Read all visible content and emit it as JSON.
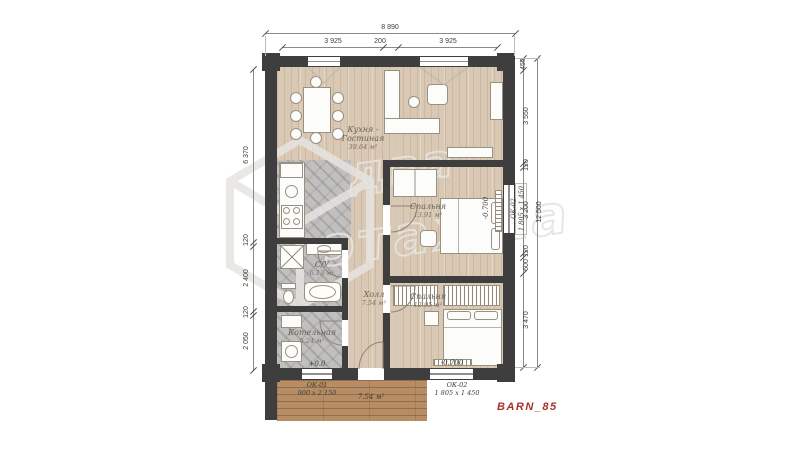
{
  "plan": {
    "code": "BARN_85",
    "watermark": {
      "line1": "два",
      "line2": "этажка"
    }
  },
  "colors": {
    "wall": "#3e3e3e",
    "wood_floor": "#d9c8b3",
    "tile_floor": "#c1c0bf",
    "deck": "#b68d64",
    "brand_red": "#a93226",
    "watermark_gray": "#e6e4e0"
  },
  "dims": {
    "top_overall": "8 890",
    "top_seg1": "3 925",
    "top_seg2": "200",
    "top_seg3": "3 925",
    "left_seg1": "6 370",
    "left_seg2": "120",
    "left_seg3": "2 400",
    "left_seg4": "120",
    "left_seg5": "2 050",
    "right_overall": "12 500",
    "right_seg1": "450",
    "right_seg2": "3 550",
    "right_seg3": "120",
    "right_seg4": "3 200",
    "right_seg5": "120",
    "right_seg6": "600",
    "right_seg7": "3 470"
  },
  "rooms": {
    "living": {
      "name_line1": "Кухня -",
      "name_line2": "Гостиная",
      "area": "39.64 м²"
    },
    "bedroom1": {
      "name": "Спальня",
      "area": "13.91 м²"
    },
    "bedroom2": {
      "name": "Спальня",
      "area": "12.95 м²"
    },
    "hall": {
      "name": "Холл",
      "area": "7.54 м²"
    },
    "bathroom": {
      "name": "С/У",
      "area": "6.13 м²"
    },
    "boiler": {
      "name": "Котельная",
      "area": "5.24 м²"
    },
    "terrace": {
      "area": "7.54 м²"
    }
  },
  "openings": {
    "ok01": {
      "code": "ОК-01",
      "size": "900 х 2 150",
      "level": "+0.0"
    },
    "ok02_bottom": {
      "code": "ОК-02",
      "size": "1 805 х 1 450",
      "level": "-0.700"
    },
    "ok02_right": {
      "code": "ОК-02",
      "size": "1 805 х 1 450",
      "level": "-0.700"
    }
  }
}
